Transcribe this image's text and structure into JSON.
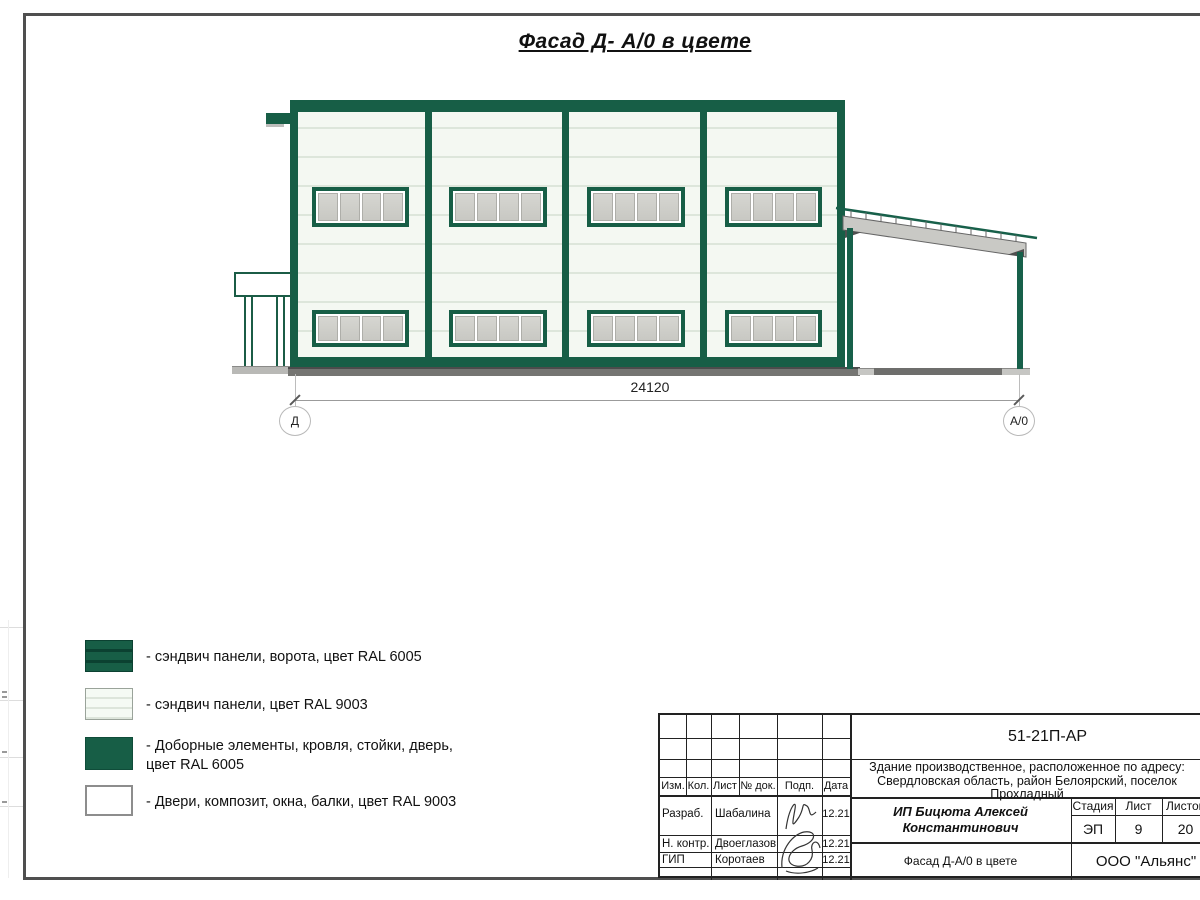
{
  "colors": {
    "ral6005_green": "#175e46",
    "ral9003_panel": "#f4f8f2",
    "window_glass_gray": "#cbcbc6",
    "ground_gray": "#757572",
    "frame_gray": "#4f4f4f"
  },
  "drawing": {
    "title": "Фасад Д- А/0 в цвете",
    "dimension_label": "24120",
    "axis_left_label": "Д",
    "axis_right_label": "А/0"
  },
  "legend": {
    "items": [
      {
        "label": "- сэндвич панели, ворота, цвет RAL 6005"
      },
      {
        "label": "- сэндвич панели, цвет RAL 9003"
      },
      {
        "label": "- Доборные элементы, кровля, стойки, дверь, цвет RAL 6005"
      },
      {
        "label": "- Двери, композит, окна, балки, цвет RAL 9003"
      }
    ]
  },
  "title_block": {
    "doc_number": "51-21П-АР",
    "address_lines": [
      "Здание производственное, расположенное по адресу:",
      "Свердловская область, район Белоярский, поселок",
      "Прохладный"
    ],
    "client_lines": [
      "ИП Бицюта Алексей",
      "Константинович"
    ],
    "sheet_title": "Фасад Д-А/0 в цвете",
    "company": "ООО \"Альянс\"",
    "columns": [
      "Изм.",
      "Кол.",
      "Лист",
      "№ док.",
      "Подп.",
      "Дата"
    ],
    "stage_label": "Стадия",
    "sheet_label": "Лист",
    "sheets_label": "Листов",
    "stage_value": "ЭП",
    "sheet_value": "9",
    "sheets_value": "20",
    "signers": [
      {
        "role": "Разраб.",
        "name": "Шабалина",
        "date": "12.21"
      },
      {
        "role": "Н. контр.",
        "name": "Двоеглазов",
        "date": "12.21"
      },
      {
        "role": "ГИП",
        "name": "Коротаев",
        "date": "12.21"
      }
    ]
  }
}
